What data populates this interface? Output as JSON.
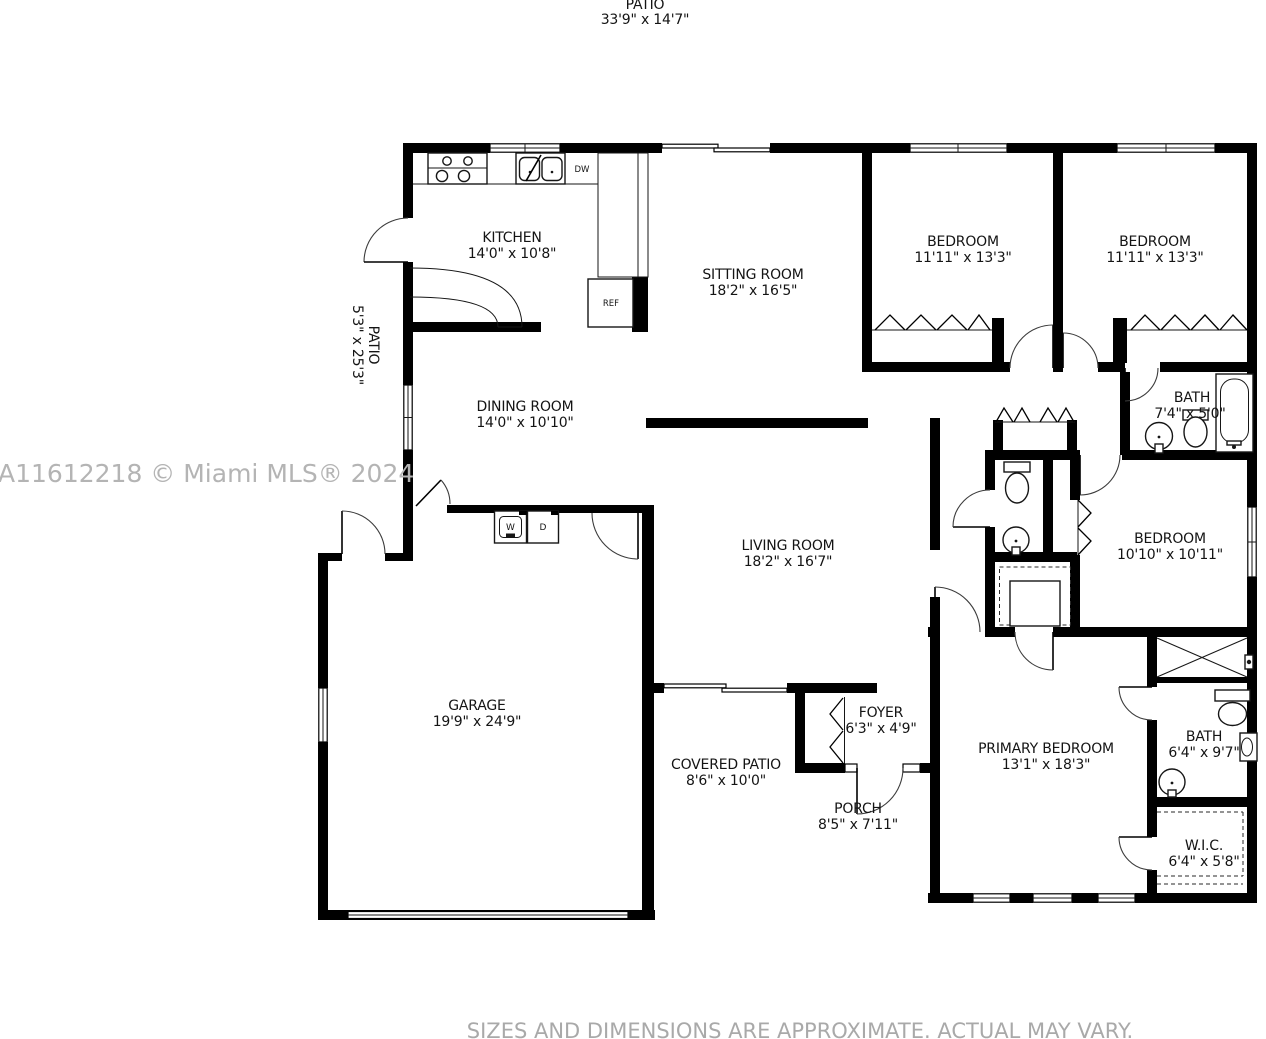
{
  "page": {
    "top_patio": {
      "label": "PATIO",
      "dims": "33'9\" x 14'7\""
    },
    "side_patio": {
      "label": "PATIO",
      "dims": "5'3\" x 25'3\""
    },
    "rooms": {
      "kitchen": {
        "label": "KITCHEN",
        "dims": "14'0\" x 10'8\""
      },
      "sitting_room": {
        "label": "SITTING ROOM",
        "dims": "18'2\" x 16'5\""
      },
      "bedroom_left": {
        "label": "BEDROOM",
        "dims": "11'11\" x 13'3\""
      },
      "bedroom_right": {
        "label": "BEDROOM",
        "dims": "11'11\" x 13'3\""
      },
      "hall_bath": {
        "label": "BATH",
        "dims": "7'4\" x 5'0\""
      },
      "dining_room": {
        "label": "DINING ROOM",
        "dims": "14'0\" x 10'10\""
      },
      "living_room": {
        "label": "LIVING ROOM",
        "dims": "18'2\" x 16'7\""
      },
      "middle_bedroom": {
        "label": "BEDROOM",
        "dims": "10'10\" x 10'11\""
      },
      "garage": {
        "label": "GARAGE",
        "dims": "19'9\" x 24'9\""
      },
      "covered_patio": {
        "label": "COVERED PATIO",
        "dims": "8'6\" x 10'0\""
      },
      "foyer": {
        "label": "FOYER",
        "dims": "6'3\" x 4'9\""
      },
      "porch": {
        "label": "PORCH",
        "dims": "8'5\" x 7'11\""
      },
      "primary_bedroom": {
        "label": "PRIMARY BEDROOM",
        "dims": "13'1\" x 18'3\""
      },
      "primary_bath": {
        "label": "BATH",
        "dims": "6'4\" x 9'7\""
      },
      "wic": {
        "label": "W.I.C.",
        "dims": "6'4\" x 5'8\""
      }
    },
    "appliances": {
      "dishwasher": "DW",
      "refrigerator": "REF",
      "washer": "W",
      "dryer": "D"
    },
    "watermark": "A11612218 © Miami MLS® 2024",
    "disclaimer": "SIZES AND DIMENSIONS ARE APPROXIMATE. ACTUAL MAY VARY.",
    "colors": {
      "wall": "#000000",
      "fixture_line": "#161616",
      "watermark": "#b4b4b4",
      "disclaimer": "#a9a9a9"
    }
  }
}
